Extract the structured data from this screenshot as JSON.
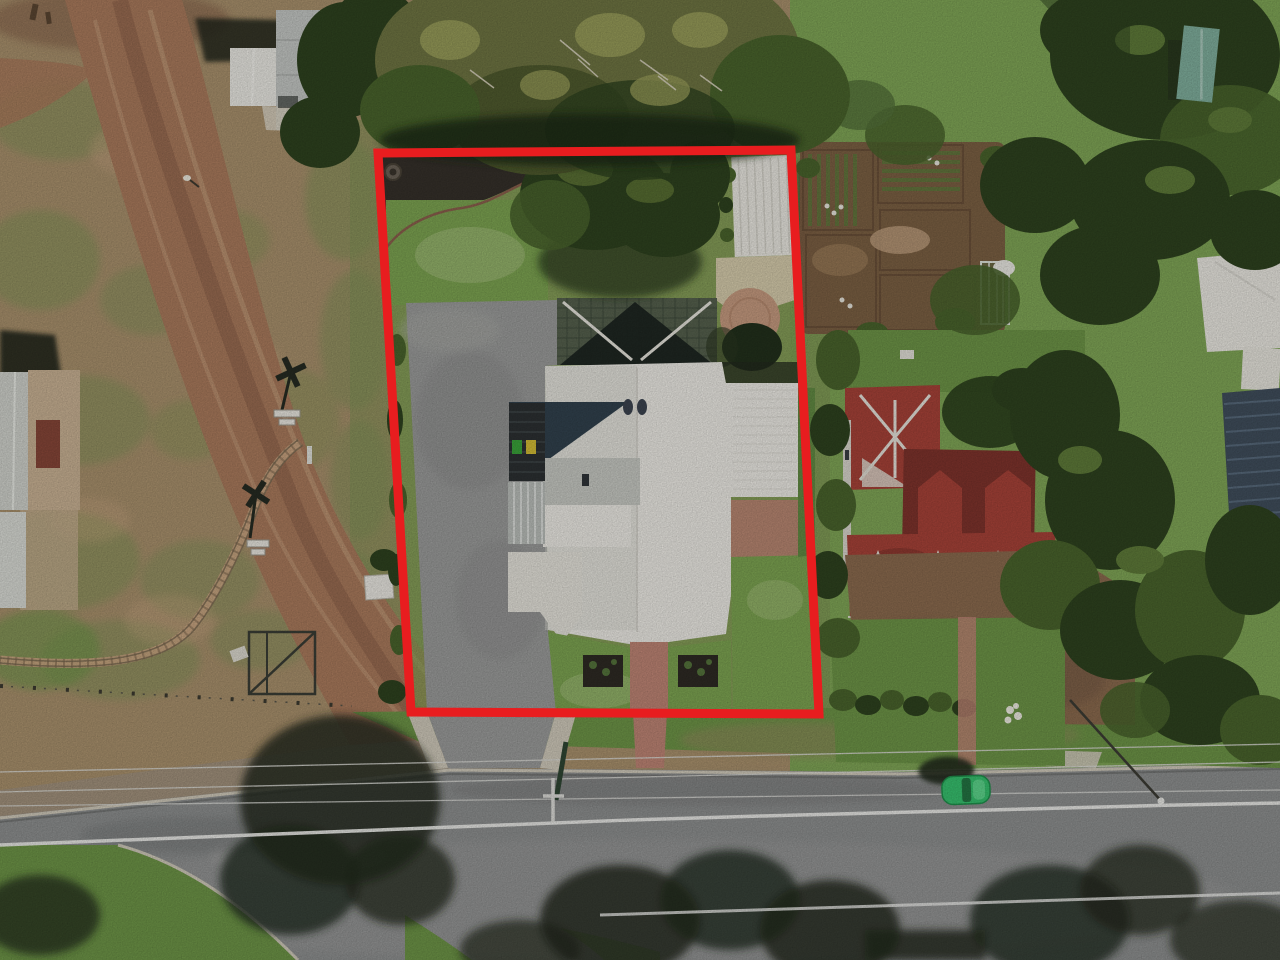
{
  "scene": {
    "type": "aerial-drone-photograph",
    "subject": "residential property for sale marked with red boundary outline, viewed from directly overhead",
    "annotation": {
      "name": "property-boundary-outline",
      "shape": "rectangle",
      "stroke_width_px": 9
    },
    "objects": [
      "dirt-road",
      "railway-crossing-signs",
      "railway-track",
      "stock-fence",
      "white-roof-main-house",
      "driveway",
      "back-lawn",
      "front-lawn",
      "garden-planters",
      "pergola-shade-structure",
      "garden-shed",
      "round-brick-patio",
      "brick-front-path",
      "neighbor-house-red-roof",
      "neighbor-garden-beds",
      "wheelie-bins",
      "satellite-dish",
      "street",
      "road-centre-line",
      "power-lines",
      "power-pole",
      "parked-green-car",
      "tree-shadows",
      "eucalyptus-canopy",
      "teal-shed",
      "solar-panel-roof",
      "left-sheds"
    ]
  },
  "palette": {
    "boundaryRed": "#e81d1f",
    "fieldTan": "#a8906c",
    "fieldOlive": "#7f9156",
    "dirtRoad": "#a97a5c",
    "dirtRoadDark": "#8a5f49",
    "dirtRoadLight": "#c9a582",
    "grassBright": "#7fa556",
    "grassMid": "#6d9447",
    "lawn": "#7ca351",
    "lawnLight": "#a3bd7c",
    "treeDark": "#2e421f",
    "treeMid": "#49632c",
    "treeOlive": "#6e7442",
    "treeOliveLight": "#959a58",
    "asphalt": "#8d8f8f",
    "asphaltDark": "#6f7171",
    "shadowDark": "#232a1e",
    "roofWhite": "#eceae4",
    "roofShade": "#d8d6cf",
    "roofNavy": "#31414d",
    "roofGray": "#c6c8c2",
    "redRoof": "#a64238",
    "redRoofDark": "#7e332c",
    "redRoofLight": "#c4776a",
    "ridgeWhite": "#e5e2da",
    "brick": "#bd8474",
    "patioTan": "#c59a7f",
    "sandTan": "#d9cdb0",
    "mulch": "#35302a",
    "tealRoof": "#7fae9c",
    "solarBlue": "#404e5c",
    "driveway": "#9a9b9a",
    "carGreen": "#37c06e",
    "lineWhite": "#ebebe8",
    "concrete": "#cfc9ba",
    "poleWhite": "#dcdcd8"
  }
}
